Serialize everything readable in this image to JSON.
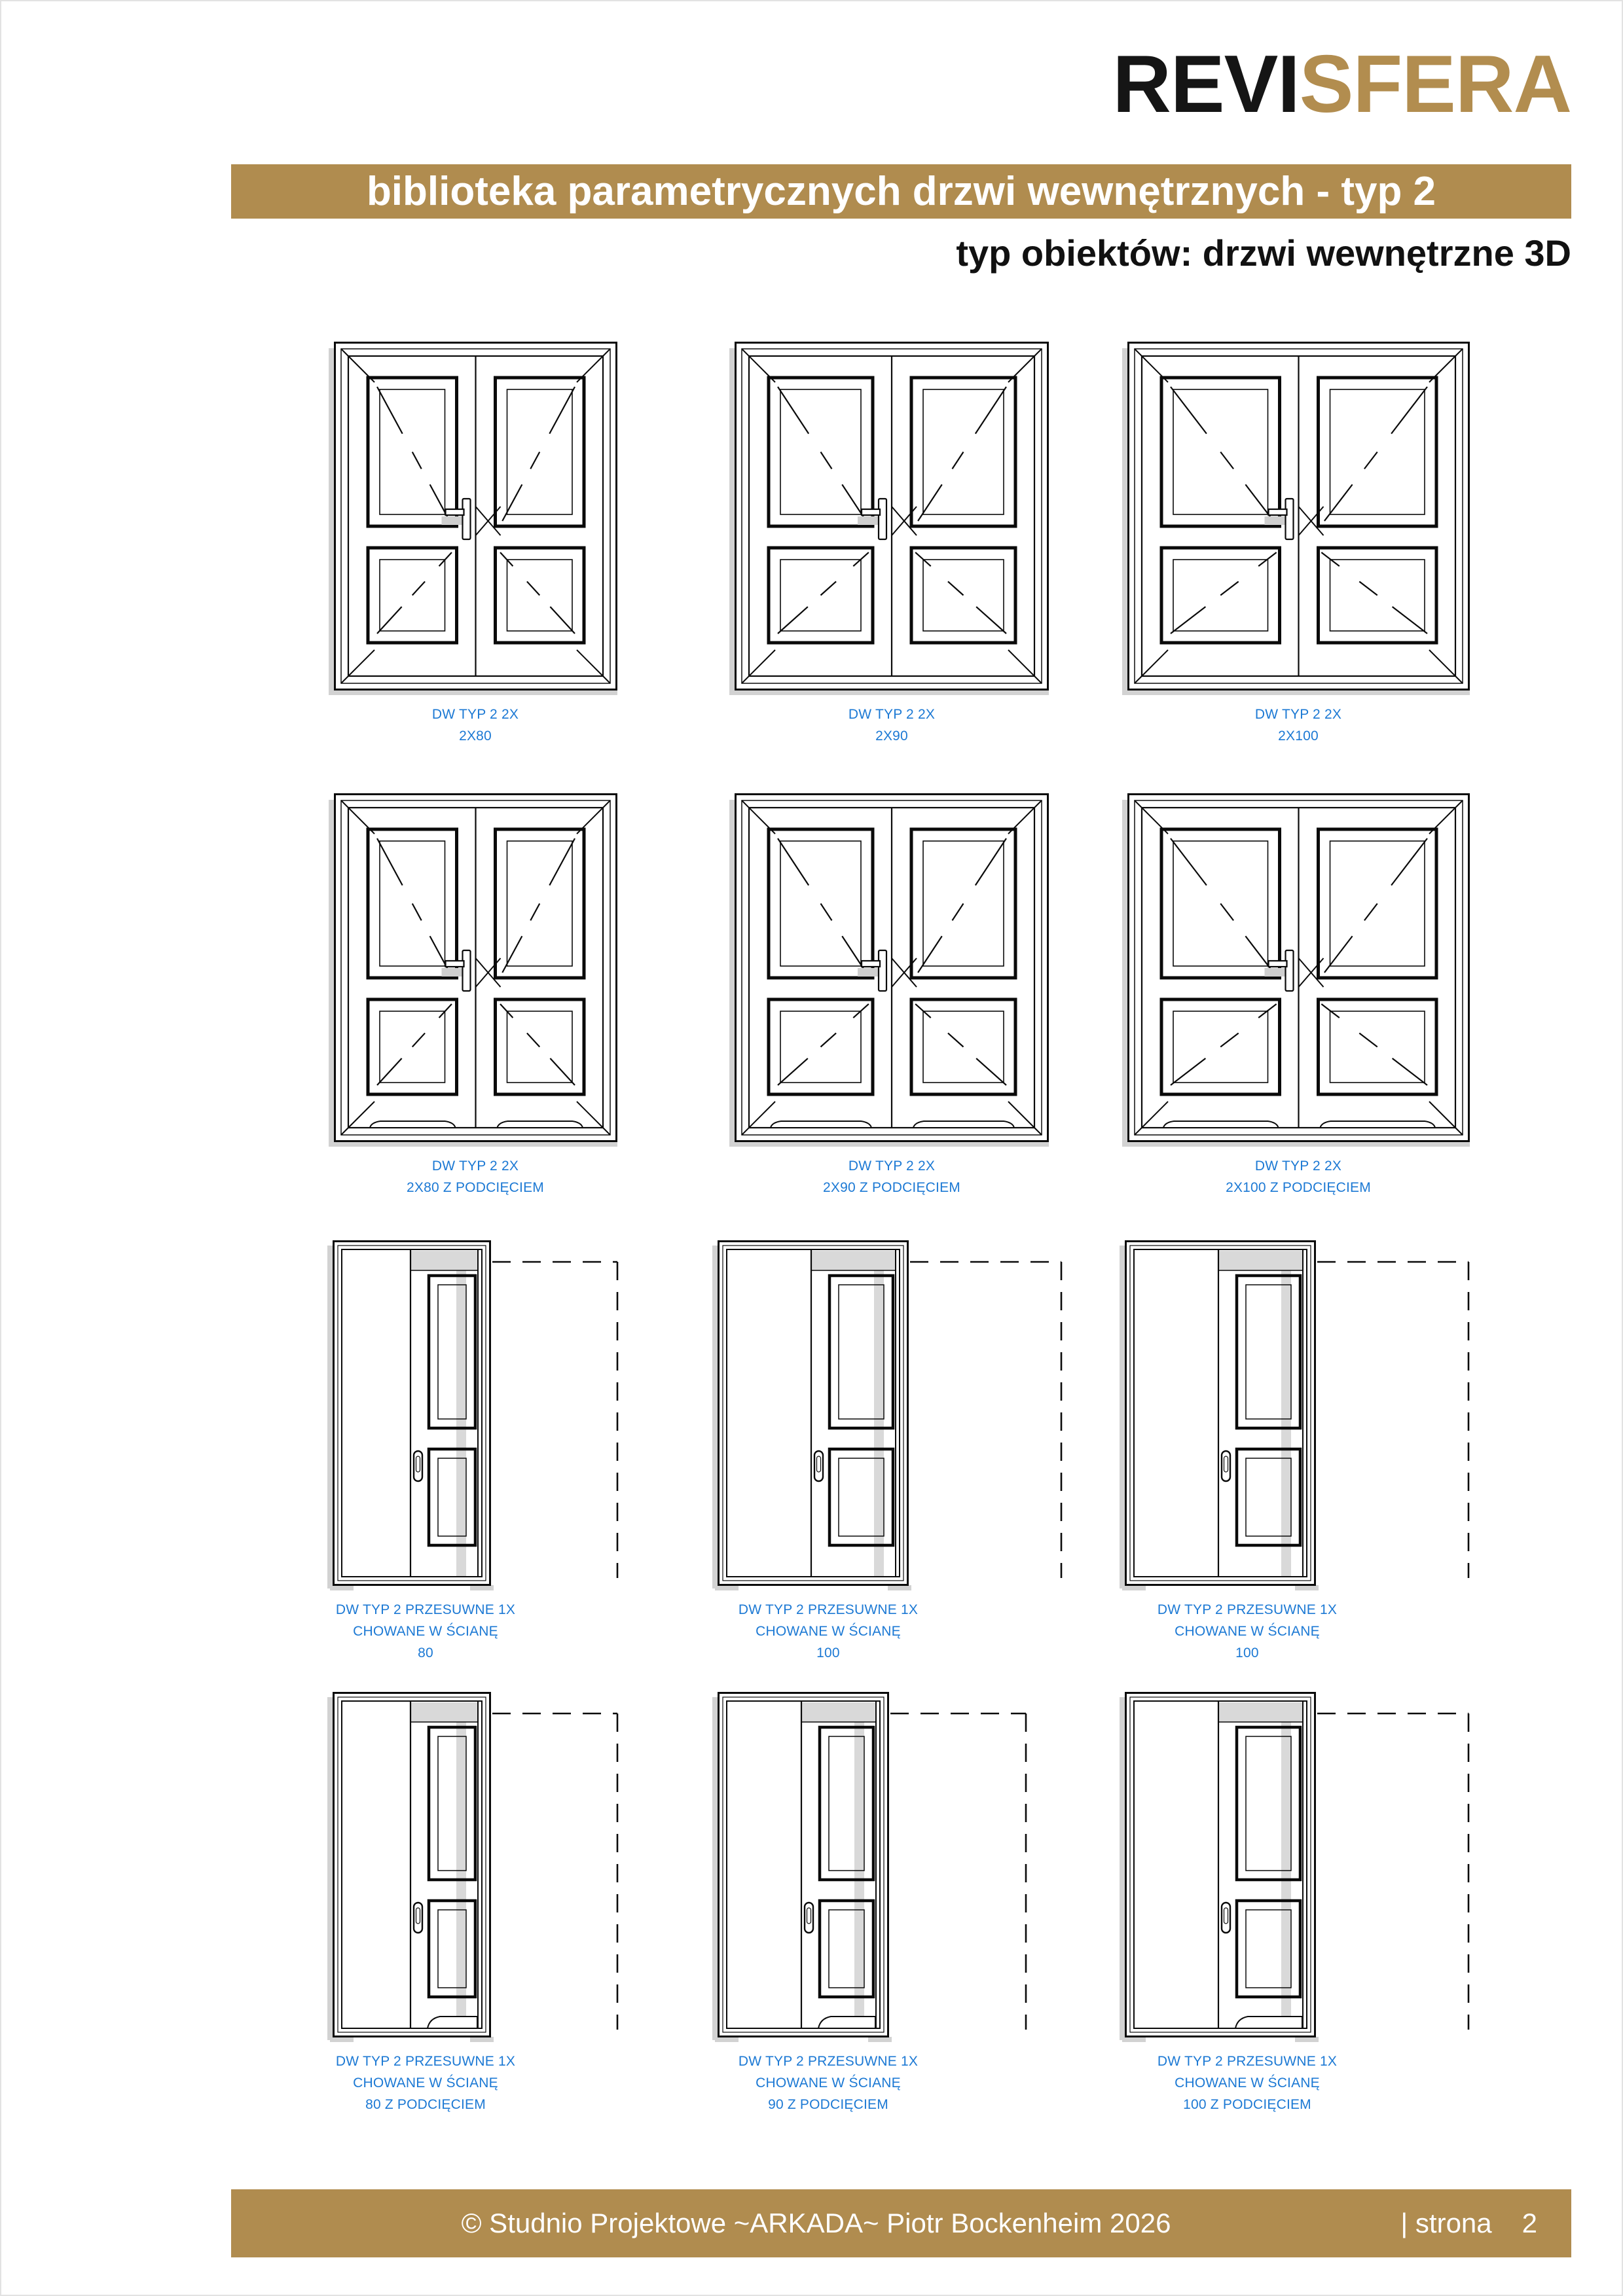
{
  "header": {
    "logo_part1": "REVI",
    "logo_part2": "SFERA",
    "banner_title": "biblioteka parametrycznych drzwi wewnętrznych - typ 2",
    "subtitle": "typ obiektów: drzwi wewnętrzne 3D"
  },
  "colors": {
    "gold": "#b08c4f",
    "logo_black": "#151515",
    "logo_gold": "#b28d4f",
    "label_blue": "#1c79d4",
    "line_black": "#0a0a0a",
    "shade_gray": "#d9d9d9",
    "shadow_gray": "#d2d2d2"
  },
  "grid": {
    "cells": [
      {
        "type": "double",
        "size_cm": 80,
        "undercut": false,
        "label_lines": [
          "DW TYP 2 2X",
          "2X80"
        ]
      },
      {
        "type": "double",
        "size_cm": 90,
        "undercut": false,
        "label_lines": [
          "DW TYP 2 2X",
          "2X90"
        ]
      },
      {
        "type": "double",
        "size_cm": 100,
        "undercut": false,
        "label_lines": [
          "DW TYP 2 2X",
          "2X100"
        ]
      },
      {
        "type": "double",
        "size_cm": 80,
        "undercut": true,
        "label_lines": [
          "DW TYP 2 2X",
          "2X80 Z PODCIĘCIEM"
        ]
      },
      {
        "type": "double",
        "size_cm": 90,
        "undercut": true,
        "label_lines": [
          "DW TYP 2 2X",
          "2X90 Z PODCIĘCIEM"
        ]
      },
      {
        "type": "double",
        "size_cm": 100,
        "undercut": true,
        "label_lines": [
          "DW TYP 2 2X",
          "2X100 Z PODCIĘCIEM"
        ]
      },
      {
        "type": "sliding",
        "size_cm": 80,
        "undercut": false,
        "label_lines": [
          "DW TYP 2 PRZESUWNE 1X",
          "CHOWANE W ŚCIANĘ",
          "80"
        ]
      },
      {
        "type": "sliding",
        "size_cm": 100,
        "undercut": false,
        "label_lines": [
          "DW TYP 2 PRZESUWNE 1X",
          "CHOWANE W ŚCIANĘ",
          "100"
        ]
      },
      {
        "type": "sliding",
        "size_cm": 100,
        "undercut": false,
        "label_lines": [
          "DW TYP 2 PRZESUWNE 1X",
          "CHOWANE W ŚCIANĘ",
          "100"
        ]
      },
      {
        "type": "sliding",
        "size_cm": 80,
        "undercut": true,
        "label_lines": [
          "DW TYP 2 PRZESUWNE 1X",
          "CHOWANE W ŚCIANĘ",
          "80 Z PODCIĘCIEM"
        ]
      },
      {
        "type": "sliding",
        "size_cm": 90,
        "undercut": true,
        "label_lines": [
          "DW TYP 2 PRZESUWNE 1X",
          "CHOWANE W ŚCIANĘ",
          "90 Z PODCIĘCIEM"
        ]
      },
      {
        "type": "sliding",
        "size_cm": 100,
        "undercut": true,
        "label_lines": [
          "DW TYP 2 PRZESUWNE 1X",
          "CHOWANE W ŚCIANĘ",
          "100 Z PODCIĘCIEM"
        ]
      }
    ]
  },
  "footer": {
    "copyright": "© Studnio Projektowe ~ARKADA~ Piotr Bockenheim 2026",
    "page_label": "| strona",
    "page_number": "2"
  }
}
